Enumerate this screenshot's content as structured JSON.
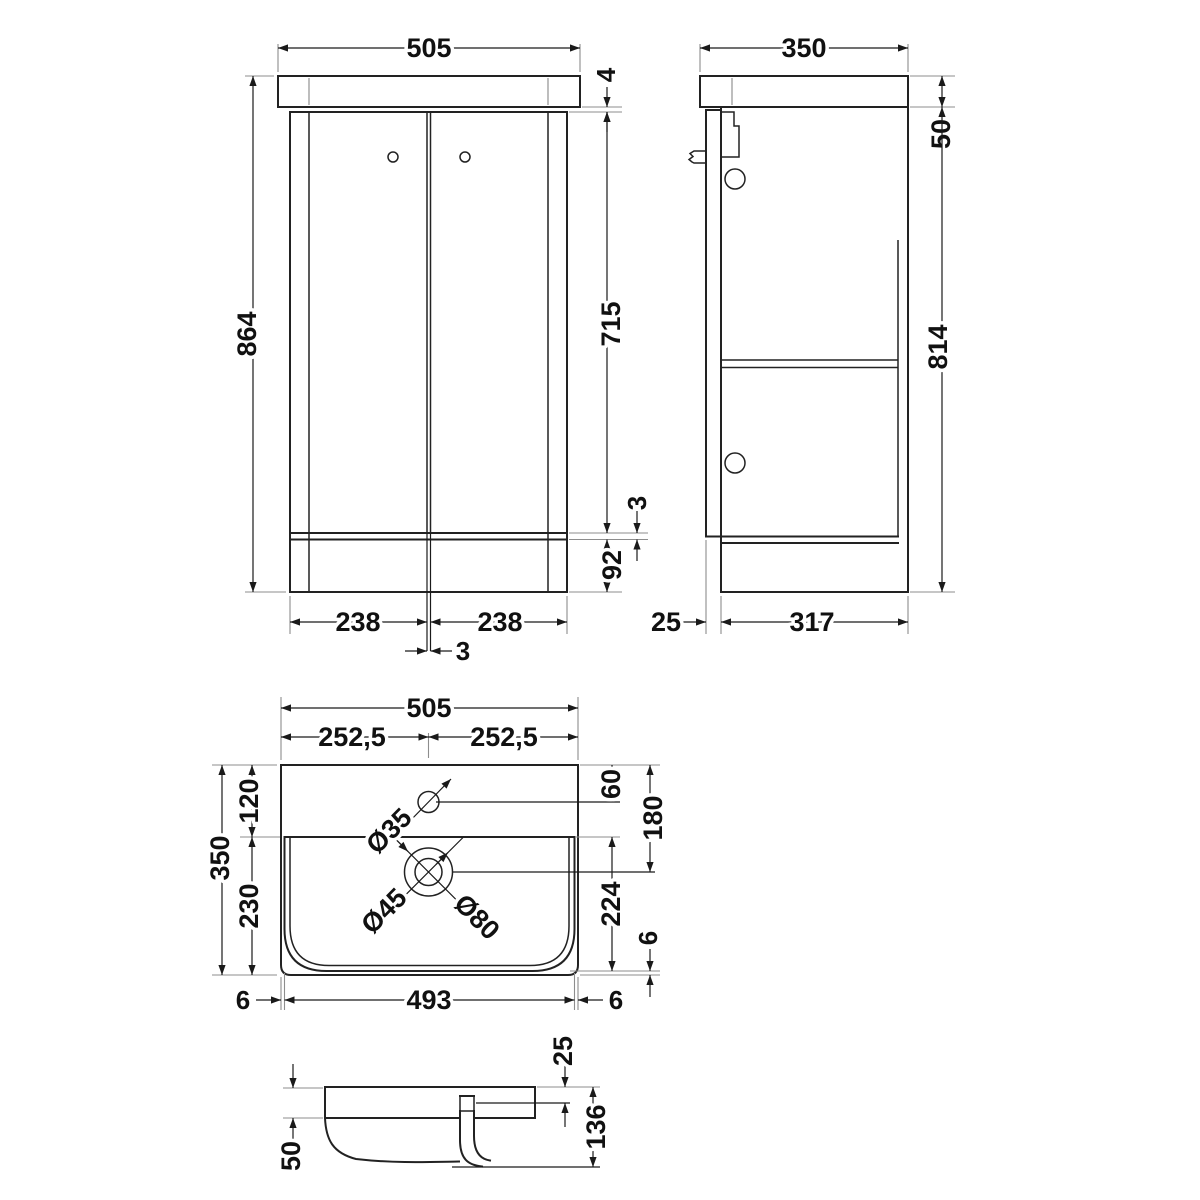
{
  "drawing": {
    "type": "vanity-unit-technical-drawing",
    "views": {
      "front": {
        "overall_width": "505",
        "worktop_gap": "4",
        "overall_height": "864",
        "door_height": "715",
        "bottom_gap": "3",
        "plinth_height": "92",
        "left_door_width": "238",
        "right_door_width": "238",
        "door_gap": "3"
      },
      "side": {
        "overall_depth": "350",
        "worktop_height": "50",
        "cabinet_height": "814",
        "door_thickness": "25",
        "body_depth": "317"
      },
      "basin_plan": {
        "overall_width": "505",
        "left_half": "252,5",
        "right_half": "252,5",
        "rear_ledge_depth": "120",
        "bowl_zone_depth": "230",
        "overall_depth": "350",
        "tap_hole_offset": "60",
        "waste_offset": "180",
        "bowl_inner_depth": "224",
        "bowl_front_gap": "6",
        "left_rim": "6",
        "bowl_width": "493",
        "right_rim": "6",
        "tap_hole_dia": "Ø35",
        "waste_dia": "Ø45",
        "overflow_dia": "Ø80"
      },
      "basin_section": {
        "waste_recess": "25",
        "overall_height": "136",
        "rim_height": "50"
      }
    }
  }
}
